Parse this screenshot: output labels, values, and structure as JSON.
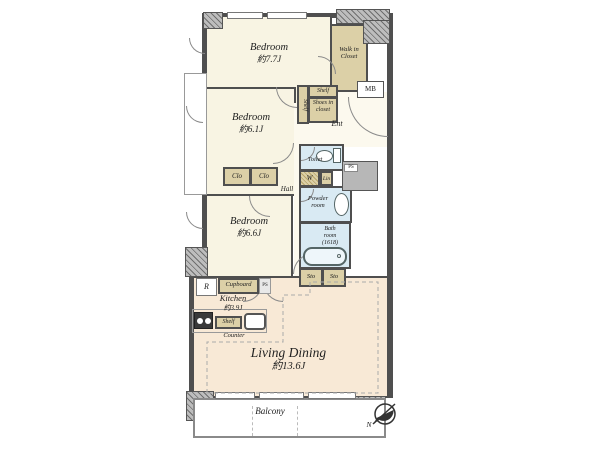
{
  "title": "apartment-floor-plan",
  "colors": {
    "room_cream": "#f8f4e3",
    "living_peach": "#f8e9d6",
    "wet_area_blue": "#d9eaf3",
    "closet_tan": "#dcd0a7",
    "wall_dark": "#4f4f4f",
    "wall_gray": "#b7b7b7"
  },
  "rooms": {
    "bedroom1": {
      "name": "Bedroom",
      "size": "約7.7J"
    },
    "bedroom2": {
      "name": "Bedroom",
      "size": "約6.1J"
    },
    "bedroom3": {
      "name": "Bedroom",
      "size": "約6.6J"
    },
    "kitchen": {
      "name": "Kitchen",
      "size": "約3.9J"
    },
    "living_dining": {
      "name": "Living Dining",
      "size": "約13.6J"
    },
    "walk_in_closet": {
      "line1": "Walk in",
      "line2": "Closet"
    },
    "powder_room": {
      "line1": "Powder",
      "line2": "room"
    },
    "bath_room": {
      "line1": "Bath",
      "line2": "room",
      "line3": "(1618)"
    },
    "toilet": {
      "name": "Toilet"
    },
    "hall": {
      "name": "Hall"
    },
    "entrance": {
      "name": "Ent"
    },
    "balcony": {
      "name": "Balcony"
    }
  },
  "fixtures": {
    "shelf_entrance_top": "Shelf",
    "shelf_entrance_side": "Shelf",
    "shoes_in_closet": {
      "line1": "Shoes in",
      "line2": "closet"
    },
    "meter_box": "MB",
    "washer": "W",
    "linen": "Lin",
    "storage1": "Sto",
    "storage2": "Sto",
    "closet1": "Clo",
    "closet2": "Clo",
    "refrigerator": "R",
    "cupboard": "Cupboard",
    "pipe_space1": "PS",
    "pipe_space2": "PS",
    "kitchen_shelf": "Shelf",
    "counter": "Counter",
    "compass_north": "N"
  }
}
